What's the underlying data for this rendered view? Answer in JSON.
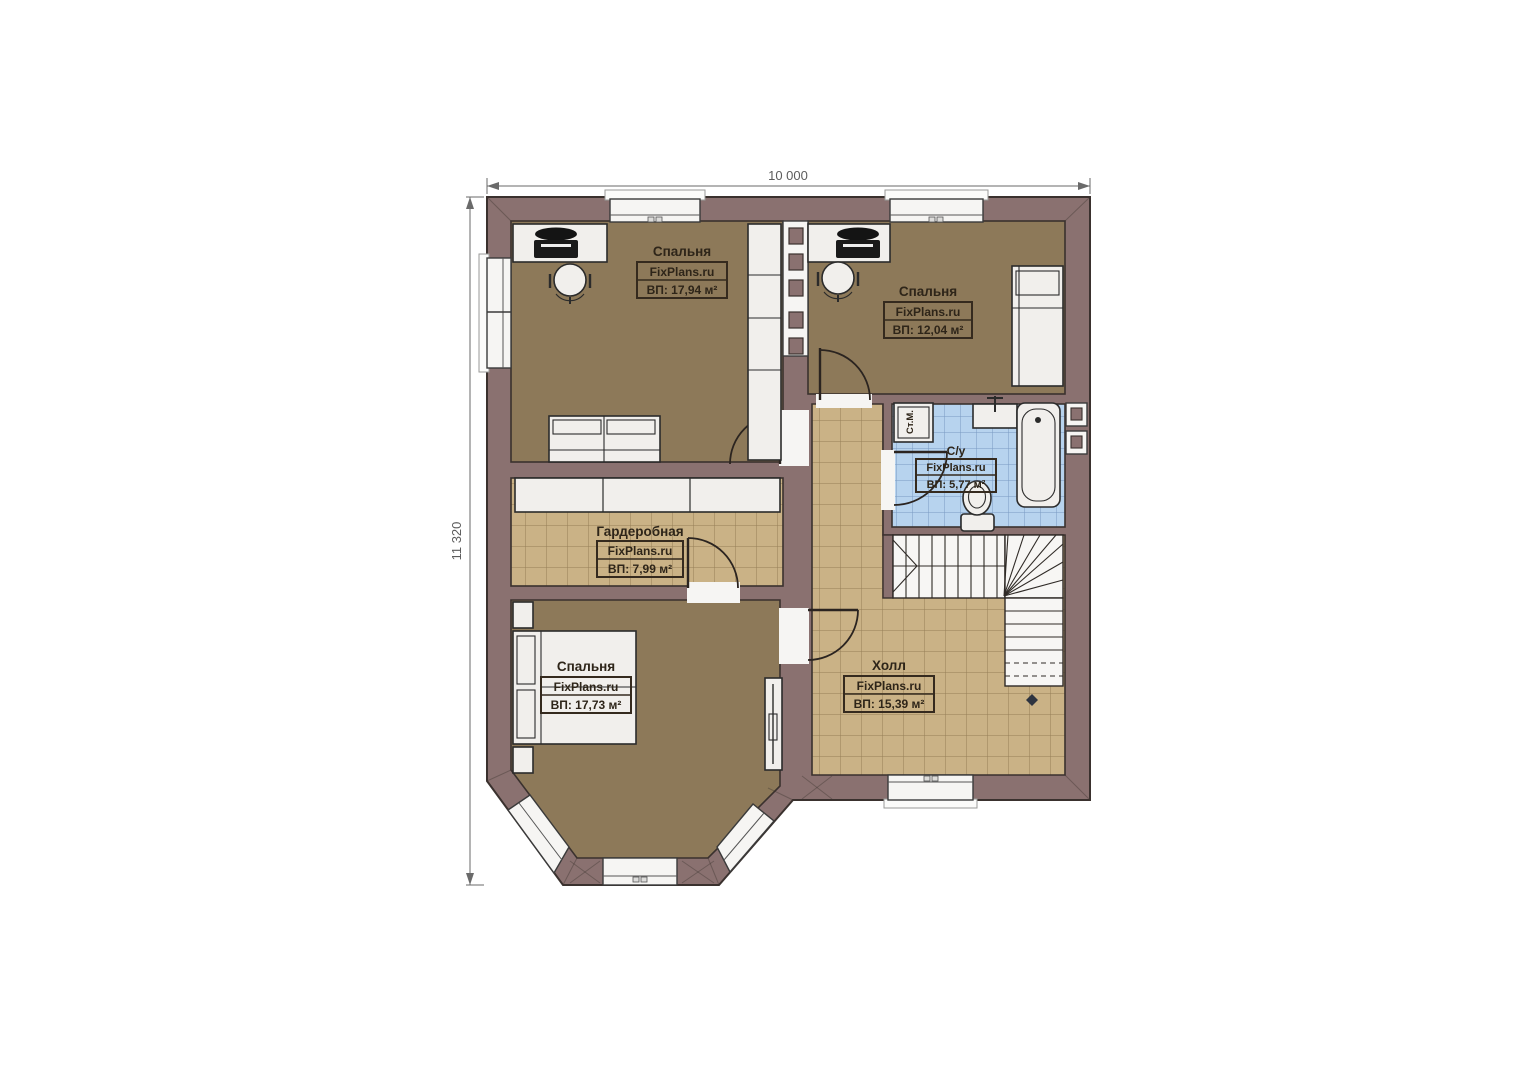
{
  "dimensions": {
    "width": "10 000",
    "height": "11 320"
  },
  "watermark": "FixPlans.ru",
  "rooms": {
    "bedroom_top_left": {
      "name": "Спальня",
      "watermark": "FixPlans.ru",
      "area": "ВП: 17,94 м²"
    },
    "bedroom_top_right": {
      "name": "Спальня",
      "watermark": "FixPlans.ru",
      "area": "ВП: 12,04 м²"
    },
    "bathroom": {
      "name": "С/у",
      "watermark": "FixPlans.ru",
      "area": "ВП: 5,77 м²"
    },
    "wardrobe": {
      "name": "Гардеробная",
      "watermark": "FixPlans.ru",
      "area": "ВП: 7,99 м²"
    },
    "bedroom_bottom": {
      "name": "Спальня",
      "watermark": "FixPlans.ru",
      "area": "ВП: 17,73 м²"
    },
    "hall": {
      "name": "Холл",
      "watermark": "FixPlans.ru",
      "area": "ВП: 15,39 м²"
    }
  },
  "labels": {
    "washing_machine": "Ст.М."
  },
  "colors": {
    "wall": "#8a7170",
    "bedroom_floor": "#8d7959",
    "tile_floor": "#cab286",
    "bath_tile": "#b7d3ee",
    "outline": "#3a312e"
  }
}
